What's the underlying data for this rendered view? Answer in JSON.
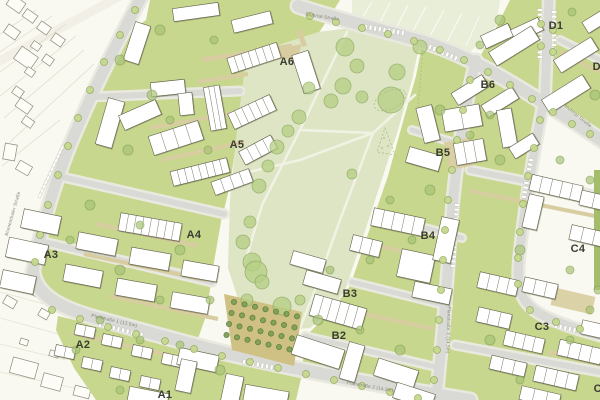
{
  "map": {
    "title": "Urban development site plan (B-Plan)",
    "kind": "architectural site plan with building blocks, park and streets",
    "blocks": [
      {
        "label": "A1"
      },
      {
        "label": "A2"
      },
      {
        "label": "A3"
      },
      {
        "label": "A4"
      },
      {
        "label": "A5"
      },
      {
        "label": "A6"
      },
      {
        "label": "B2"
      },
      {
        "label": "B3"
      },
      {
        "label": "B4"
      },
      {
        "label": "B5"
      },
      {
        "label": "B6"
      },
      {
        "label": "C2"
      },
      {
        "label": "C3"
      },
      {
        "label": "C4"
      },
      {
        "label": "D1"
      },
      {
        "label": "D2"
      }
    ],
    "streets": [
      {
        "name": "Blumenthaler Straße"
      },
      {
        "name": "Planstraße 1 (12.5m)"
      },
      {
        "name": "Planstraße 2 (14.5m)"
      },
      {
        "name": "Planstraße 3 (14.5m)"
      },
      {
        "name": "Stuhrtal-Straße"
      },
      {
        "name": "Stuhrtal-Straße"
      }
    ],
    "palette": {
      "existing_bg": "#f9f8f1",
      "lawn": "#c7d78d",
      "park": "#dde5c4",
      "field": "#e9eed9",
      "road": "#d9d9d5",
      "sidewalk": "#eae9e0",
      "path_tan": "#d8cda0",
      "orchard_ground": "#cfc184",
      "building_fill": "#ffffff",
      "building_stroke": "#61614b",
      "building_shadow": "#6f6f52",
      "tree_park": "#b6cf83",
      "tree_block": "#a9c476",
      "tree_street": "#c6d88f",
      "tree_orchard": "#7fa055",
      "existing_outline": "#8c8c7c",
      "label_color": "#3b3b32",
      "street_label_color": "#84847a"
    }
  }
}
